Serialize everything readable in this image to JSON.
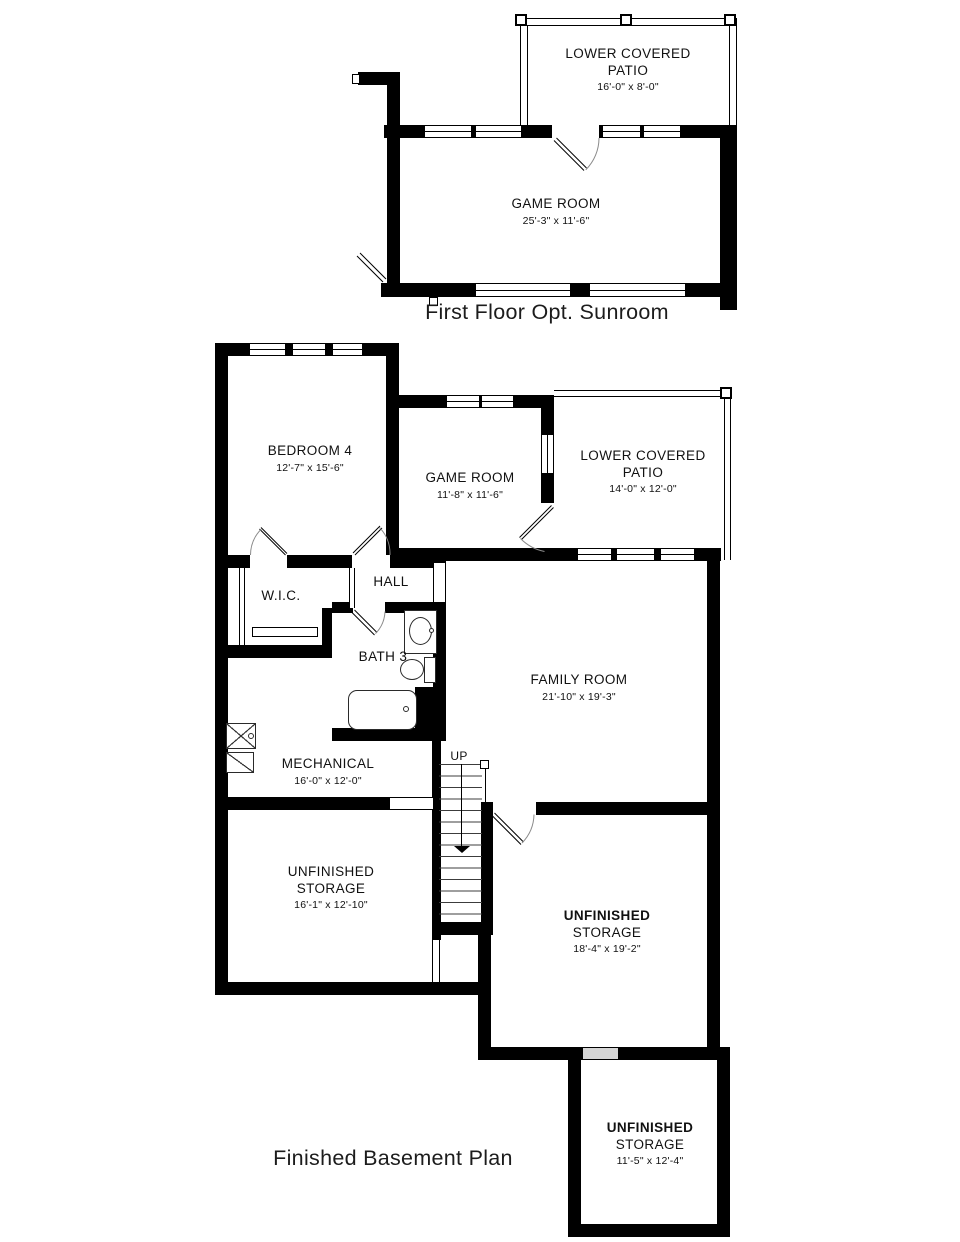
{
  "page": {
    "background": "#ffffff",
    "ink": "#000000",
    "opening_fill": "#d6d6d6"
  },
  "top_plan": {
    "caption": "First Floor Opt. Sunroom",
    "rooms": {
      "patio": {
        "name_line1": "LOWER COVERED",
        "name_line2": "PATIO",
        "dims": "16'-0\" x 8'-0\""
      },
      "game_room": {
        "name": "GAME ROOM",
        "dims": "25'-3\" x 11'-6\""
      }
    }
  },
  "basement_plan": {
    "caption": "Finished Basement Plan",
    "stairs_label": "UP",
    "rooms": {
      "bedroom4": {
        "name": "BEDROOM 4",
        "dims": "12'-7\" x 15'-6\""
      },
      "game_room": {
        "name": "GAME ROOM",
        "dims": "11'-8\" x 11'-6\""
      },
      "patio": {
        "name_line1": "LOWER COVERED",
        "name_line2": "PATIO",
        "dims": "14'-0\" x 12'-0\""
      },
      "wic": {
        "name": "W.I.C."
      },
      "hall": {
        "name": "HALL"
      },
      "bath3": {
        "name": "BATH 3"
      },
      "family_room": {
        "name": "FAMILY ROOM",
        "dims": "21'-10\" x 19'-3\""
      },
      "mechanical": {
        "name": "MECHANICAL",
        "dims": "16'-0\" x 12'-0\""
      },
      "storage_left": {
        "name_line1": "UNFINISHED",
        "name_line2": "STORAGE",
        "dims": "16'-1\" x 12'-10\""
      },
      "storage_right": {
        "name_line1": "UNFINISHED",
        "name_line2": "STORAGE",
        "dims": "18'-4\" x 19'-2\""
      },
      "storage_bottom": {
        "name_line1": "UNFINISHED",
        "name_line2": "STORAGE",
        "dims": "11'-5\" x 12'-4\""
      }
    }
  }
}
